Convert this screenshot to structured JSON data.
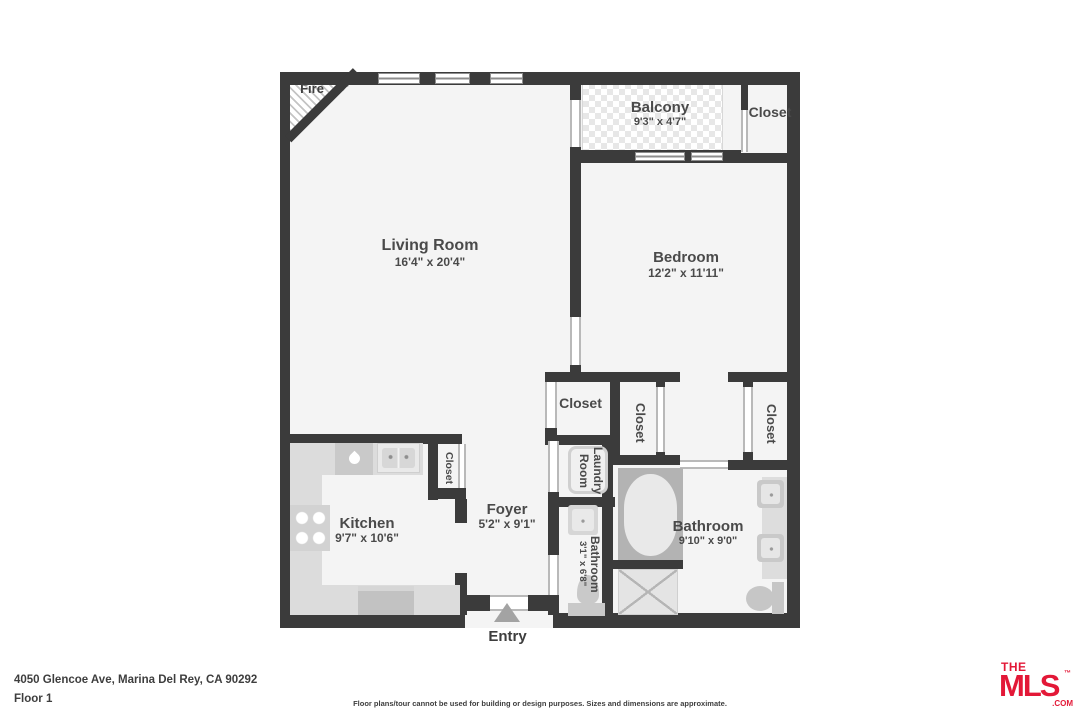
{
  "plan": {
    "fire_label": "Fire",
    "entry_label": "Entry",
    "rooms": {
      "living_room": {
        "name": "Living Room",
        "dims": "16'4\" x 20'4\""
      },
      "bedroom": {
        "name": "Bedroom",
        "dims": "12'2\" x 11'11\""
      },
      "balcony": {
        "name": "Balcony",
        "dims": "9'3\" x 4'7\""
      },
      "kitchen": {
        "name": "Kitchen",
        "dims": "9'7\" x 10'6\""
      },
      "foyer": {
        "name": "Foyer",
        "dims": "5'2\" x 9'1\""
      },
      "bathroom": {
        "name": "Bathroom",
        "dims": "9'10\" x 9'0\""
      },
      "bathroom_small": {
        "name": "Bathroom",
        "dims": "3'1\" x 6'8\""
      },
      "laundry": {
        "lines": [
          "Laundry",
          "Room"
        ]
      }
    },
    "closets": {
      "balcony": "Closet",
      "hall": "Closet",
      "mid": "Closet",
      "bedroom": "Closet",
      "kitchen": "Closet"
    }
  },
  "footer": {
    "address": "4050 Glencoe Ave, Marina Del Rey, CA 90292",
    "floor": "Floor 1",
    "disclaimer": "Floor plans/tour cannot be used for building or design purposes. Sizes and dimensions are approximate.",
    "logo": {
      "the": "THE",
      "mls": "MLS",
      "tm": "™",
      "com": ".COM"
    }
  },
  "colors": {
    "wall": "#3b3b3b",
    "floor": "#f4f4f4",
    "accent_red": "#e31837"
  }
}
